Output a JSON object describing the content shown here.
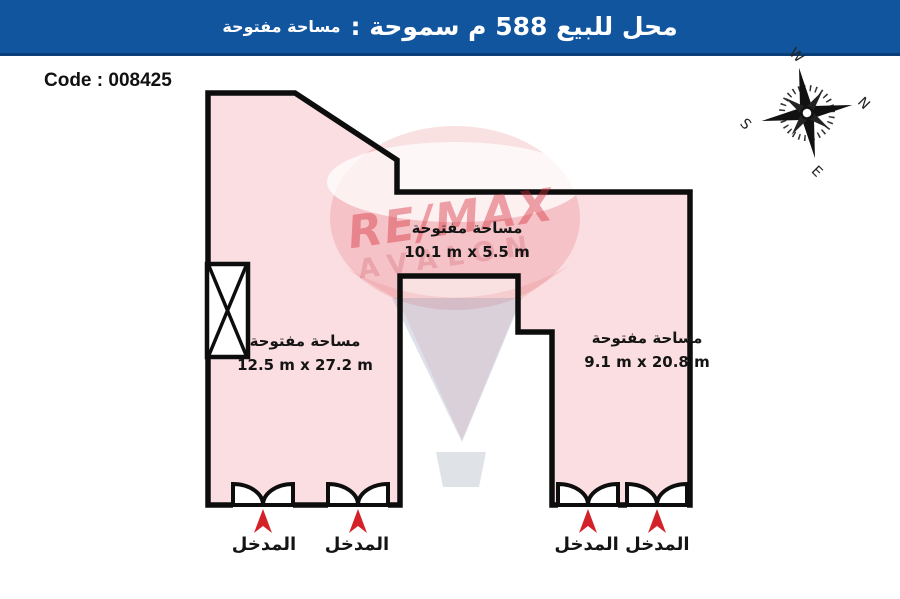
{
  "header": {
    "title_main": "محل للبيع 588 م سموحة :",
    "title_sub": "مساحة مفتوحة"
  },
  "code_label": "Code : 008425",
  "compass": {
    "n": "N",
    "e": "E",
    "s": "S",
    "w": "W"
  },
  "watermark": {
    "brand": "RE/MAX",
    "sub": "AVALON"
  },
  "colors": {
    "header_bg": "#11559f",
    "header_border": "#0a3e78",
    "plan_fill": "#fbdee1",
    "outline": "#0d0d0d",
    "arrow_red": "#d42127",
    "brand_red": "#d8232a"
  },
  "areas": [
    {
      "name": "مساحة مفتوحة",
      "dims": "10.1 m x 5.5 m"
    },
    {
      "name": "مساحة مفتوحة",
      "dims": "12.5 m x 27.2 m"
    },
    {
      "name": "مساحة مفتوحة",
      "dims": "9.1 m x 20.8 m"
    }
  ],
  "entrances": [
    {
      "label": "المدخل"
    },
    {
      "label": "المدخل"
    },
    {
      "label": "المدخل المدخل"
    }
  ]
}
